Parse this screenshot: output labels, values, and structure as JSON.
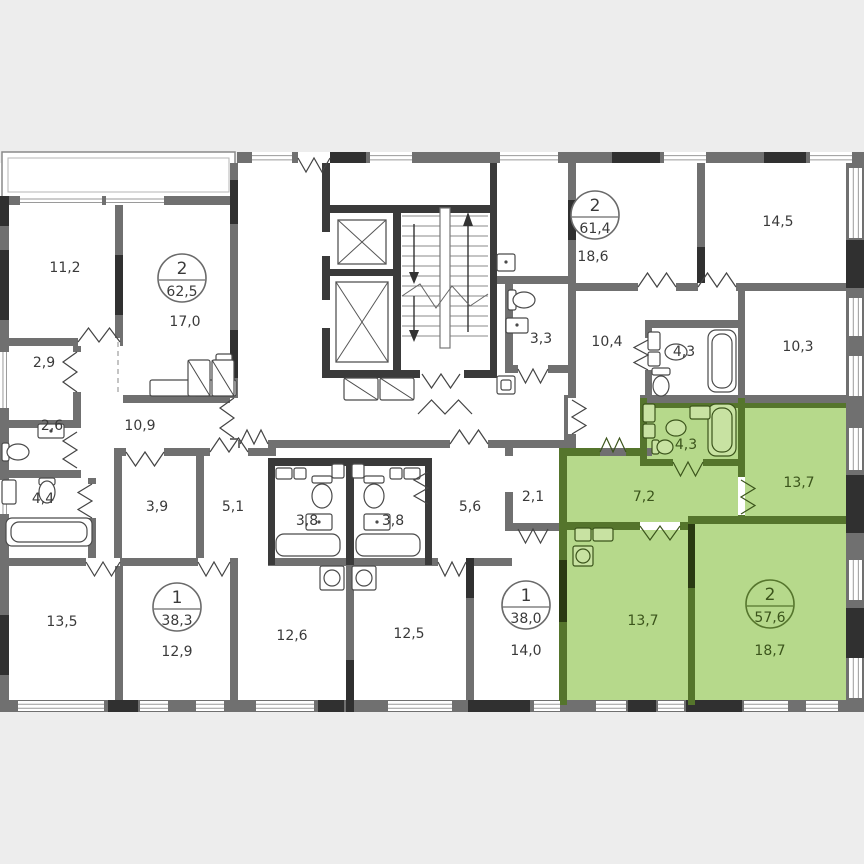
{
  "title": "Floor plan with highlighted 2-room apartment",
  "colors": {
    "background": "#ededed",
    "floor": "#ffffff",
    "wall": "#707070",
    "wall_dark": "#303030",
    "block_wall": "#3a3a3a",
    "window_line": "#9a9a9a",
    "fixture_stroke": "#4a4a4a",
    "text": "#3a3a3a",
    "highlight_fill": "#b6d98b",
    "highlight_wall": "#55752c",
    "highlight_dark": "#2a3a12",
    "highlight_fixture_fill": "#c8e2a2",
    "highlight_text": "#3b541b"
  },
  "apartments": [
    {
      "name": "apartment-62-5",
      "rooms_count": "2",
      "total_area": "62,5",
      "highlighted": false
    },
    {
      "name": "apartment-38-3",
      "rooms_count": "1",
      "total_area": "38,3",
      "highlighted": false
    },
    {
      "name": "apartment-38-0",
      "rooms_count": "1",
      "total_area": "38,0",
      "highlighted": false
    },
    {
      "name": "apartment-61-4",
      "rooms_count": "2",
      "total_area": "61,4",
      "highlighted": false
    },
    {
      "name": "apartment-57-6",
      "rooms_count": "2",
      "total_area": "57,6",
      "highlighted": true
    }
  ],
  "rooms": [
    {
      "name": "room-11-2",
      "area": "11,2"
    },
    {
      "name": "room-17-0",
      "area": "17,0"
    },
    {
      "name": "hall-2-9",
      "area": "2,9"
    },
    {
      "name": "wc-2-6",
      "area": "2,6"
    },
    {
      "name": "hall-10-9",
      "area": "10,9"
    },
    {
      "name": "bath-4-4",
      "area": "4,4"
    },
    {
      "name": "room-3-9",
      "area": "3,9"
    },
    {
      "name": "hall-5-1",
      "area": "5,1"
    },
    {
      "name": "room-13-5",
      "area": "13,5"
    },
    {
      "name": "room-12-9",
      "area": "12,9"
    },
    {
      "name": "bath-3-8-left",
      "area": "3,8"
    },
    {
      "name": "bath-3-8-right",
      "area": "3,8"
    },
    {
      "name": "room-12-6",
      "area": "12,6"
    },
    {
      "name": "room-12-5",
      "area": "12,5"
    },
    {
      "name": "hall-5-6",
      "area": "5,6"
    },
    {
      "name": "wardrobe-2-1",
      "area": "2,1"
    },
    {
      "name": "room-14-0",
      "area": "14,0"
    },
    {
      "name": "bath-3-3",
      "area": "3,3"
    },
    {
      "name": "room-18-6",
      "area": "18,6"
    },
    {
      "name": "room-14-5",
      "area": "14,5"
    },
    {
      "name": "hall-10-4",
      "area": "10,4"
    },
    {
      "name": "bath-4-3",
      "area": "4,3"
    },
    {
      "name": "room-10-3",
      "area": "10,3"
    },
    {
      "name": "bath-4-3-green",
      "area": "4,3"
    },
    {
      "name": "hall-7-2-green",
      "area": "7,2"
    },
    {
      "name": "room-13-7-top-green",
      "area": "13,7"
    },
    {
      "name": "room-13-7-bottom-green",
      "area": "13,7"
    },
    {
      "name": "room-18-7-green",
      "area": "18,7"
    }
  ]
}
